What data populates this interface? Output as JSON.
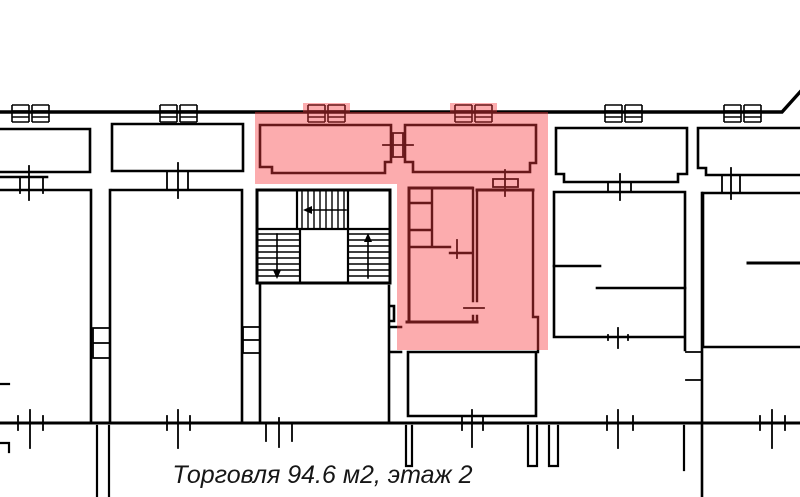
{
  "plan": {
    "type": "floor-plan",
    "caption": "Торговля 94.6 м2, этаж 2",
    "usage": "Торговля",
    "unit_area_m2": "94.6",
    "floor": "2",
    "highlight_color": "rgba(248,58,62,0.42)",
    "wall_color": "#000000",
    "background_color": "#ffffff"
  }
}
